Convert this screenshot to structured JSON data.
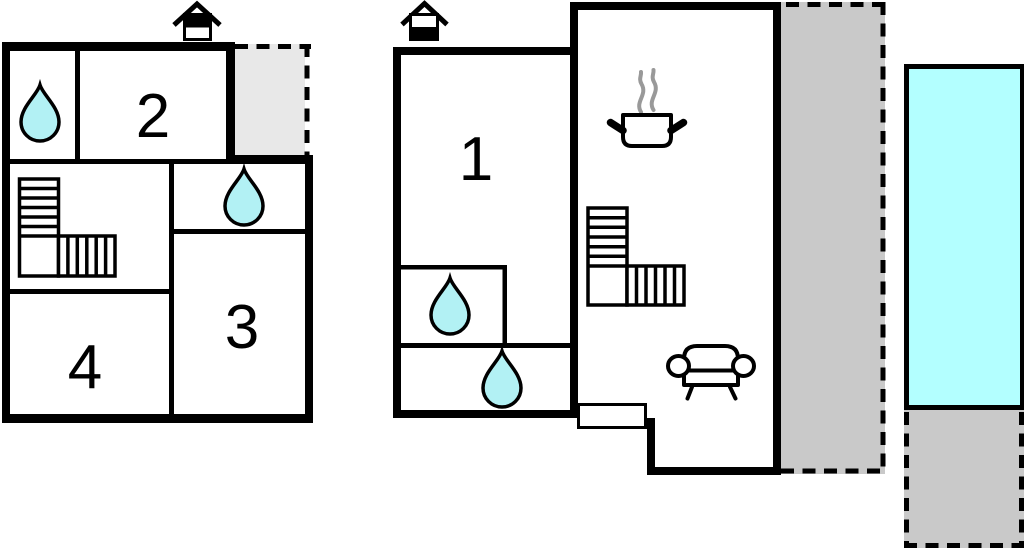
{
  "page": {
    "title": "Holiday house floor plan with swimming pool"
  },
  "rooms": {
    "room1": "1",
    "room2": "2",
    "room3": "3",
    "room4": "4"
  },
  "colors": {
    "wall": "#000000",
    "water_drop": "#b2f1f4",
    "pool_water": "#b3ffff",
    "terrace_gray": "#c9c9c9",
    "balcony_gray": "#e8e8e8",
    "steam_gray": "#999999",
    "door_fill": "#ffffff",
    "background": "#ffffff"
  },
  "icons": {
    "fireplace": "fireplace-chimney-icon",
    "water_drop": "water-drop-icon",
    "staircase": "staircase-icon",
    "cooking_pot": "cooking-pot-icon",
    "steam": "steam-icon",
    "sofa": "sofa-icon"
  }
}
